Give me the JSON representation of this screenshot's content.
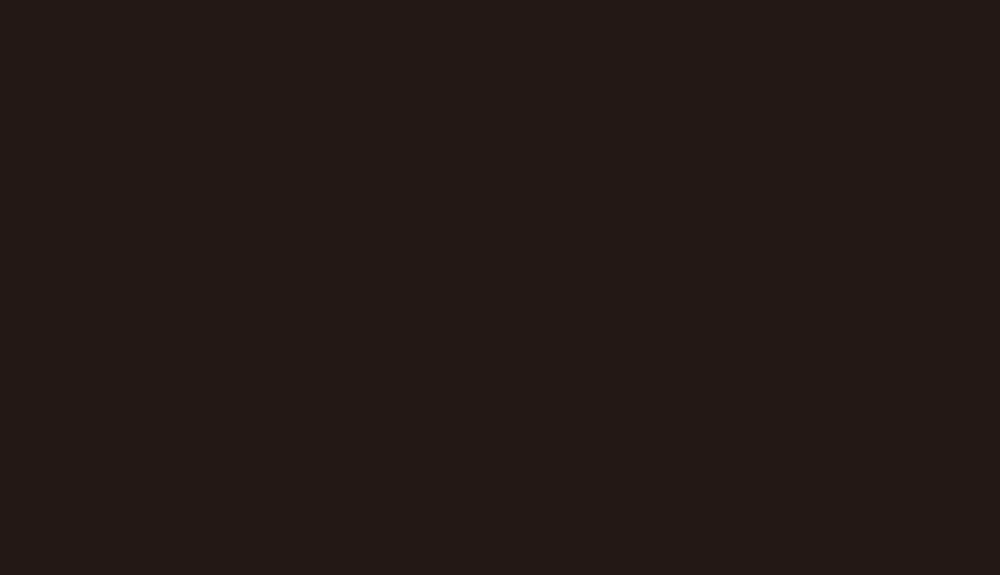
{
  "screen": {
    "state": "blank",
    "background_color": "#231815",
    "visible_text": "",
    "visible_elements": []
  }
}
